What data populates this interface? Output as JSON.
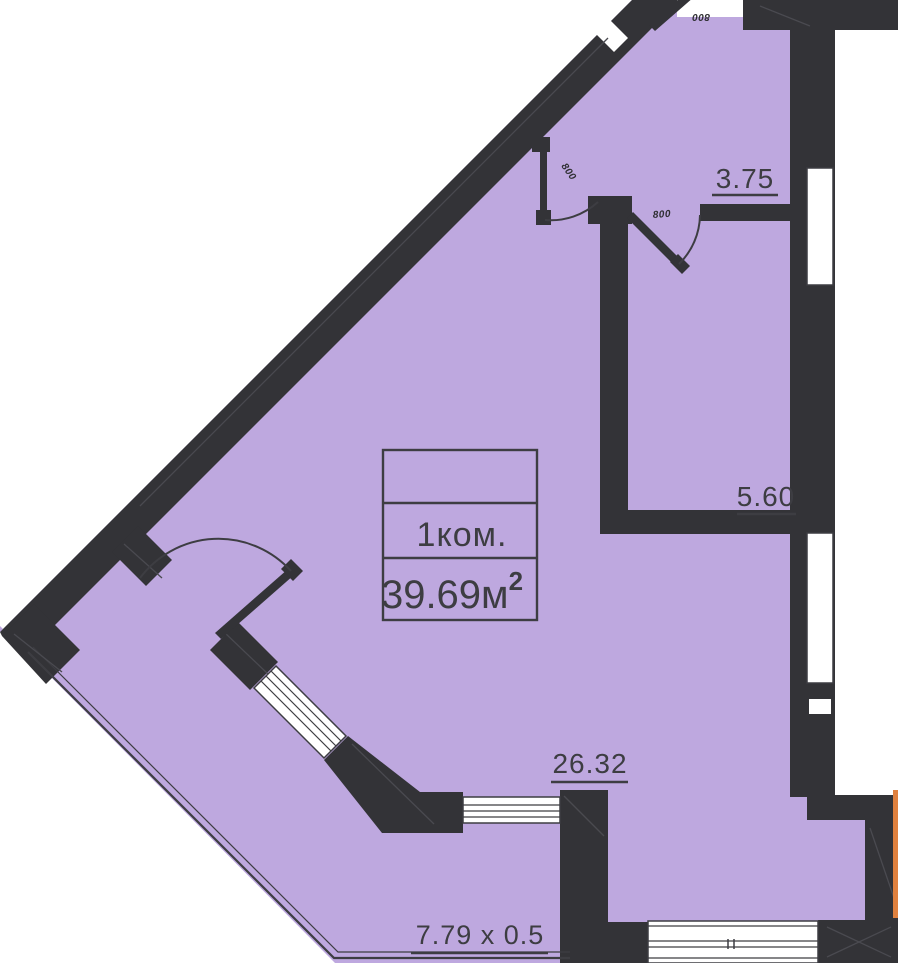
{
  "plan": {
    "colors": {
      "background": "#ffffff",
      "apartment_fill": "#BEA8DF",
      "wall": "#333337",
      "text": "#3D3D42",
      "adjacent_section_marker": "#E0813E",
      "window": "#ffffff"
    },
    "title_block": {
      "room_type": "1ком.",
      "area_main": "39.69м",
      "area_sup": "2"
    },
    "area_labels": {
      "hallway": "3.75",
      "bathroom": "5.60",
      "living_room": "26.32",
      "balcony": "7.79 x 0.5"
    },
    "door_width_labels": {
      "entrance": "800",
      "hallway_living": "800",
      "hallway_bathroom": "800"
    }
  }
}
